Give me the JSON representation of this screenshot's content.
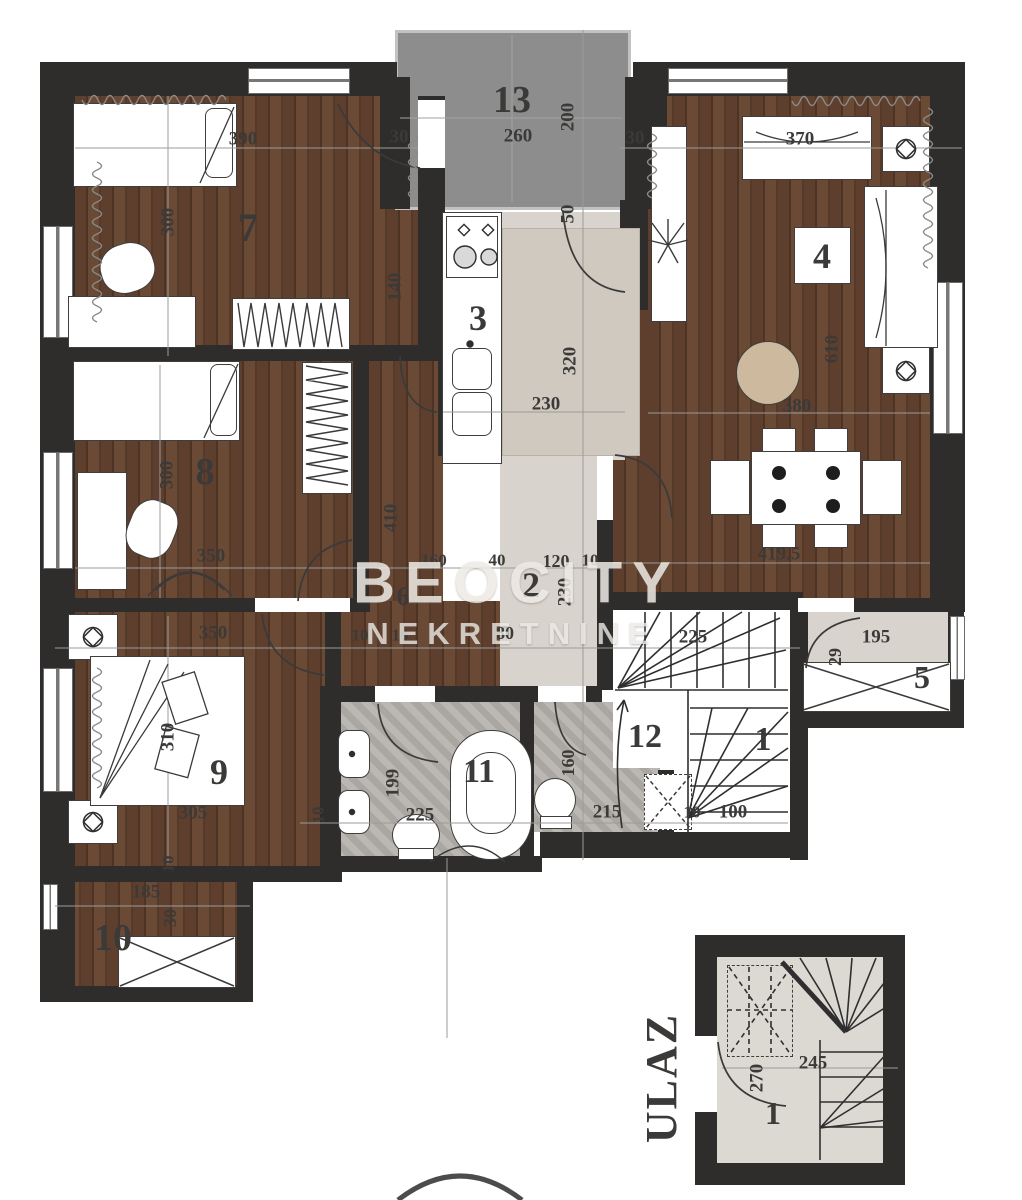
{
  "watermark": {
    "line1": "BEOCITY",
    "line2": "NEKRETNINE"
  },
  "colors": {
    "wall": "#2e2d2b",
    "wood": "#5e3f2e",
    "tile": "#d8d4cd",
    "terrace": "#8d8d8d",
    "bath_tile": "#b4b1ac",
    "pouf": "#cdb99d"
  },
  "labels": [
    {
      "t": "13",
      "x": 512,
      "y": 100,
      "s": 38,
      "kind": "room"
    },
    {
      "t": "7",
      "x": 248,
      "y": 228,
      "s": 40,
      "kind": "room"
    },
    {
      "t": "4",
      "x": 822,
      "y": 256,
      "s": 36,
      "kind": "room"
    },
    {
      "t": "3",
      "x": 478,
      "y": 318,
      "s": 36,
      "kind": "room"
    },
    {
      "t": "8",
      "x": 205,
      "y": 472,
      "s": 38,
      "kind": "room"
    },
    {
      "t": "2",
      "x": 531,
      "y": 585,
      "s": 36,
      "kind": "room"
    },
    {
      "t": "6",
      "x": 403,
      "y": 597,
      "s": 26,
      "kind": "room"
    },
    {
      "t": "5",
      "x": 922,
      "y": 677,
      "s": 32,
      "kind": "room"
    },
    {
      "t": "1",
      "x": 763,
      "y": 740,
      "s": 34,
      "kind": "room"
    },
    {
      "t": "9",
      "x": 219,
      "y": 772,
      "s": 36,
      "kind": "room"
    },
    {
      "t": "11",
      "x": 479,
      "y": 772,
      "s": 34,
      "kind": "room"
    },
    {
      "t": "12",
      "x": 645,
      "y": 737,
      "s": 34,
      "kind": "room"
    },
    {
      "t": "10",
      "x": 113,
      "y": 938,
      "s": 38,
      "kind": "room"
    },
    {
      "t": "1",
      "x": 773,
      "y": 1113,
      "s": 32,
      "kind": "room"
    },
    {
      "t": "390",
      "x": 243,
      "y": 139,
      "s": 19,
      "kind": "dim"
    },
    {
      "t": "30",
      "x": 399,
      "y": 137,
      "s": 19,
      "kind": "dim"
    },
    {
      "t": "260",
      "x": 518,
      "y": 136,
      "s": 19,
      "kind": "dim"
    },
    {
      "t": "30",
      "x": 635,
      "y": 138,
      "s": 19,
      "kind": "dim"
    },
    {
      "t": "200",
      "x": 568,
      "y": 117,
      "s": 19,
      "r": -90,
      "kind": "dim"
    },
    {
      "t": "370",
      "x": 800,
      "y": 139,
      "s": 19,
      "kind": "dim"
    },
    {
      "t": "300",
      "x": 168,
      "y": 222,
      "s": 19,
      "r": -90,
      "kind": "dim"
    },
    {
      "t": "140",
      "x": 395,
      "y": 287,
      "s": 19,
      "r": -90,
      "kind": "dim"
    },
    {
      "t": "50",
      "x": 568,
      "y": 214,
      "s": 19,
      "r": -90,
      "kind": "dim"
    },
    {
      "t": "230",
      "x": 546,
      "y": 404,
      "s": 19,
      "kind": "dim"
    },
    {
      "t": "320",
      "x": 570,
      "y": 361,
      "s": 19,
      "r": -90,
      "kind": "dim"
    },
    {
      "t": "610",
      "x": 832,
      "y": 349,
      "s": 19,
      "r": -90,
      "kind": "dim"
    },
    {
      "t": "380",
      "x": 797,
      "y": 406,
      "s": 19,
      "kind": "dim"
    },
    {
      "t": "419.5",
      "x": 779,
      "y": 554,
      "s": 19,
      "kind": "dim"
    },
    {
      "t": "300",
      "x": 167,
      "y": 475,
      "s": 19,
      "r": -90,
      "kind": "dim"
    },
    {
      "t": "410",
      "x": 391,
      "y": 518,
      "s": 19,
      "r": -90,
      "kind": "dim"
    },
    {
      "t": "350",
      "x": 211,
      "y": 556,
      "s": 19,
      "kind": "dim"
    },
    {
      "t": "160",
      "x": 434,
      "y": 560,
      "s": 17,
      "kind": "dim"
    },
    {
      "t": "40",
      "x": 497,
      "y": 560,
      "s": 17,
      "kind": "dim"
    },
    {
      "t": "120",
      "x": 556,
      "y": 561,
      "s": 18,
      "kind": "dim"
    },
    {
      "t": "10",
      "x": 590,
      "y": 560,
      "s": 17,
      "kind": "dim"
    },
    {
      "t": "230",
      "x": 565,
      "y": 592,
      "s": 19,
      "r": -90,
      "kind": "dim"
    },
    {
      "t": "350",
      "x": 213,
      "y": 633,
      "s": 19,
      "kind": "dim"
    },
    {
      "t": "10",
      "x": 360,
      "y": 635,
      "s": 17,
      "kind": "dim"
    },
    {
      "t": "10",
      "x": 400,
      "y": 635,
      "s": 17,
      "kind": "dim"
    },
    {
      "t": "80",
      "x": 505,
      "y": 633,
      "s": 18,
      "kind": "dim"
    },
    {
      "t": "225",
      "x": 693,
      "y": 637,
      "s": 19,
      "kind": "dim"
    },
    {
      "t": "195",
      "x": 876,
      "y": 637,
      "s": 19,
      "kind": "dim"
    },
    {
      "t": "29",
      "x": 835,
      "y": 657,
      "s": 18,
      "r": -90,
      "kind": "dim"
    },
    {
      "t": "310",
      "x": 168,
      "y": 737,
      "s": 19,
      "r": -90,
      "kind": "dim"
    },
    {
      "t": "305",
      "x": 193,
      "y": 813,
      "s": 19,
      "kind": "dim"
    },
    {
      "t": "199",
      "x": 393,
      "y": 783,
      "s": 19,
      "r": -90,
      "kind": "dim"
    },
    {
      "t": "225",
      "x": 420,
      "y": 815,
      "s": 19,
      "kind": "dim"
    },
    {
      "t": "10",
      "x": 318,
      "y": 815,
      "s": 17,
      "r": -90,
      "kind": "dim"
    },
    {
      "t": "160",
      "x": 568,
      "y": 763,
      "s": 18,
      "r": -90,
      "kind": "dim"
    },
    {
      "t": "215",
      "x": 607,
      "y": 812,
      "s": 19,
      "kind": "dim"
    },
    {
      "t": "10",
      "x": 692,
      "y": 812,
      "s": 17,
      "kind": "dim"
    },
    {
      "t": "100",
      "x": 733,
      "y": 812,
      "s": 19,
      "kind": "dim"
    },
    {
      "t": "10",
      "x": 168,
      "y": 864,
      "s": 17,
      "r": -90,
      "kind": "dim"
    },
    {
      "t": "185",
      "x": 146,
      "y": 892,
      "s": 19,
      "kind": "dim"
    },
    {
      "t": "30",
      "x": 170,
      "y": 918,
      "s": 18,
      "r": -90,
      "kind": "dim"
    },
    {
      "t": "270",
      "x": 757,
      "y": 1078,
      "s": 19,
      "r": -90,
      "kind": "dim"
    },
    {
      "t": "245",
      "x": 813,
      "y": 1063,
      "s": 19,
      "kind": "dim"
    },
    {
      "t": "ULAZ",
      "x": 662,
      "y": 1078,
      "s": 44,
      "r": -90,
      "kind": "entrance"
    }
  ]
}
